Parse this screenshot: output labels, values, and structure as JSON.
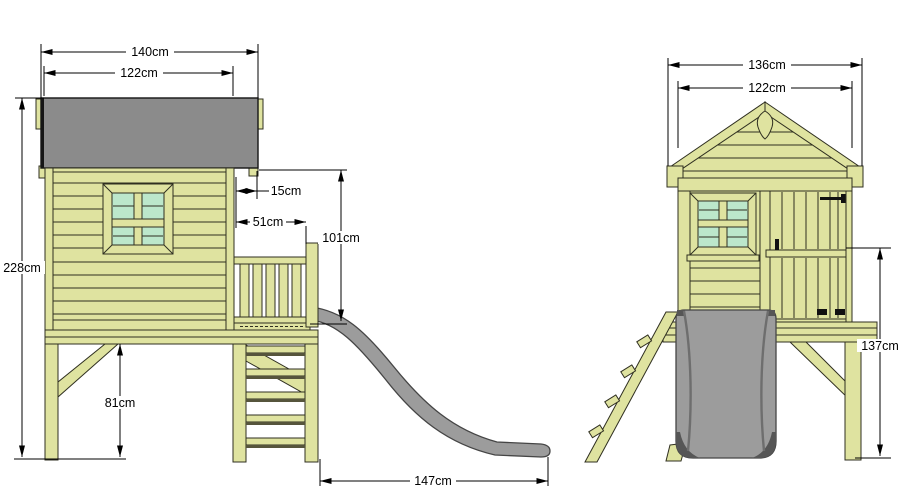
{
  "dimensions": {
    "side_view": {
      "overall_width": "140cm",
      "house_width": "122cm",
      "overall_height": "228cm",
      "roof_overhang": "15cm",
      "platform_depth": "51cm",
      "eave_to_platform": "101cm",
      "floor_height": "81cm",
      "slide_length": "147cm"
    },
    "front_view": {
      "overall_width": "136cm",
      "house_width": "122cm",
      "platform_height": "137cm"
    }
  },
  "colors": {
    "wood": "#dfe3a0",
    "glass": "#bce7cb",
    "roof": "#8b8b8b",
    "slide": "#9c9c9c",
    "slide-dark": "#565656",
    "outline": "#2f2f20",
    "dim": "#000000",
    "bg": "#ffffff"
  }
}
